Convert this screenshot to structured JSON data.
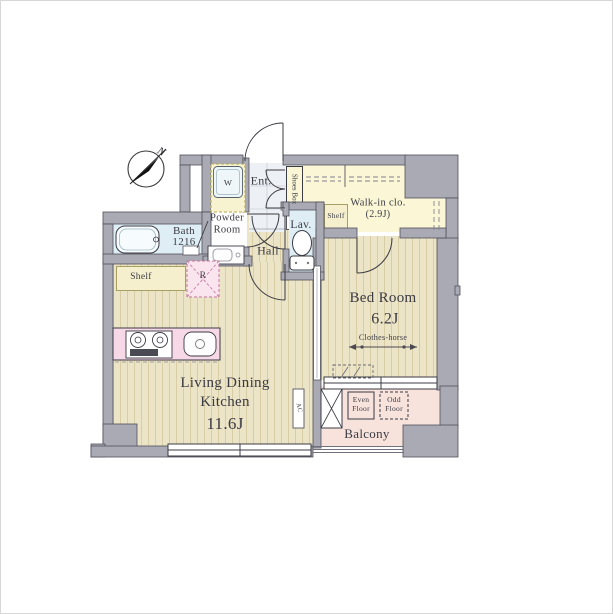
{
  "compass": {
    "north_label": "N"
  },
  "rooms": {
    "living_dining_kitchen": {
      "line1": "Living Dining",
      "line2": "Kitchen",
      "size": "11.6J"
    },
    "bed_room": {
      "name": "Bed Room",
      "size": "6.2J"
    },
    "walk_in_closet": {
      "name": "Walk-in clo.",
      "size": "(2.9J)"
    },
    "hall": {
      "name": "Hall"
    },
    "lavatory": {
      "name": "Lav."
    },
    "bath": {
      "name": "Bath",
      "size": "1216"
    },
    "powder_room": {
      "line1": "Powder",
      "line2": "Room"
    },
    "entrance": {
      "name": "Ent."
    },
    "shoes_box": {
      "name": "Shoes Box"
    },
    "balcony": {
      "name": "Balcony"
    }
  },
  "fixtures": {
    "kitchen_shelf": "Shelf",
    "closet_shelf": "Shelf",
    "washing_machine": "W",
    "refrigerator": "R",
    "air_conditioner": "AC",
    "clothes_horse": "Clothes-horse",
    "even_floor": {
      "line1": "Even",
      "line2": "Floor"
    },
    "odd_floor": {
      "line1": "Odd",
      "line2": "Floor"
    }
  },
  "colors": {
    "wall": "#a9aab4",
    "wood_floor": "#ece4c6",
    "closet_yellow": "#faf6d6",
    "wet_area_blue": "#dfeef5",
    "kitchen_pink": "#f6d8e6",
    "balcony_pink": "#f8e3dc",
    "entrance_tile": "#edf0f4"
  }
}
